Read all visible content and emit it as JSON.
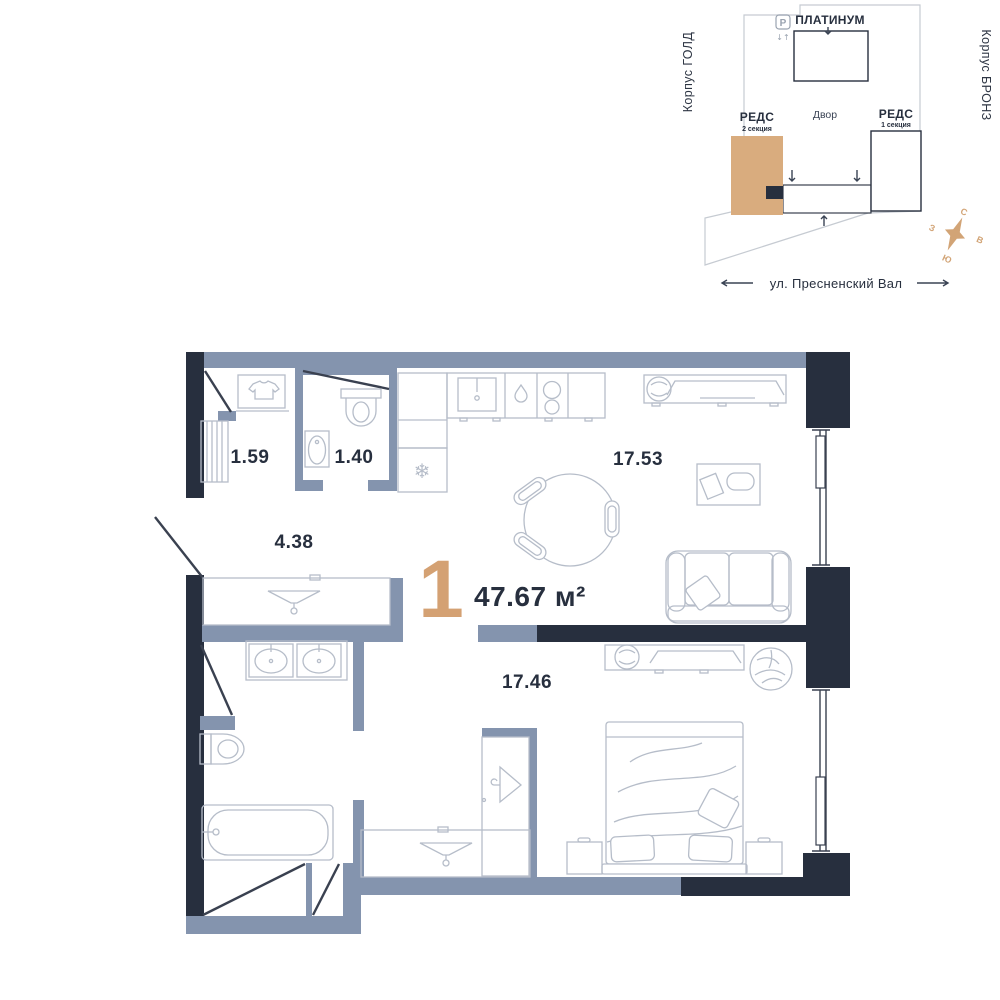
{
  "plan": {
    "rooms_count": "1",
    "total_area": "47.67 м²",
    "rooms": {
      "storage": "1.59",
      "bathroom_small": "1.40",
      "hallway": "4.38",
      "kitchen_living": "17.53",
      "bedroom": "17.46"
    },
    "icons": {
      "fridge_snowflake": "❄"
    }
  },
  "minimap": {
    "platinum": "ПЛАТИНУМ",
    "yard": "Двор",
    "reds2": "РЕДС",
    "reds2_section": "2 секция",
    "reds1": "РЕДС",
    "reds1_section": "1 секция",
    "korpus_gold": "Корпус ГОЛД",
    "korpus_bronze": "Корпус БРОНЗ",
    "parking": "P",
    "lift": "↓↑",
    "street": "ул. Пресненский Вал",
    "compass": {
      "n": "С",
      "s": "Ю",
      "w": "З",
      "e": "В"
    }
  },
  "colors": {
    "accent_tan": "#D4A173",
    "building_tan": "#D9AC7E",
    "wall_blue_gray": "#8494AE",
    "wall_dark_navy": "#272F3E"
  }
}
